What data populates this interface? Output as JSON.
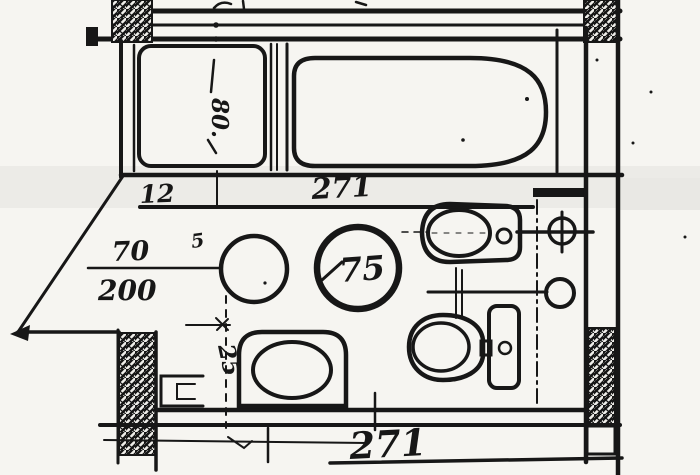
{
  "colors": {
    "ink": "#171717",
    "paper": "#f6f5f1"
  },
  "labels": {
    "dim_wall_offset": "12",
    "dim_width_top": "271",
    "dim_door_width": "70",
    "dim_room_depth": "200",
    "dim_shower": "80.",
    "dim_round_basin": "75",
    "dim_gap": "5",
    "dim_side_fixture": "25",
    "dim_width_bottom": "271"
  }
}
